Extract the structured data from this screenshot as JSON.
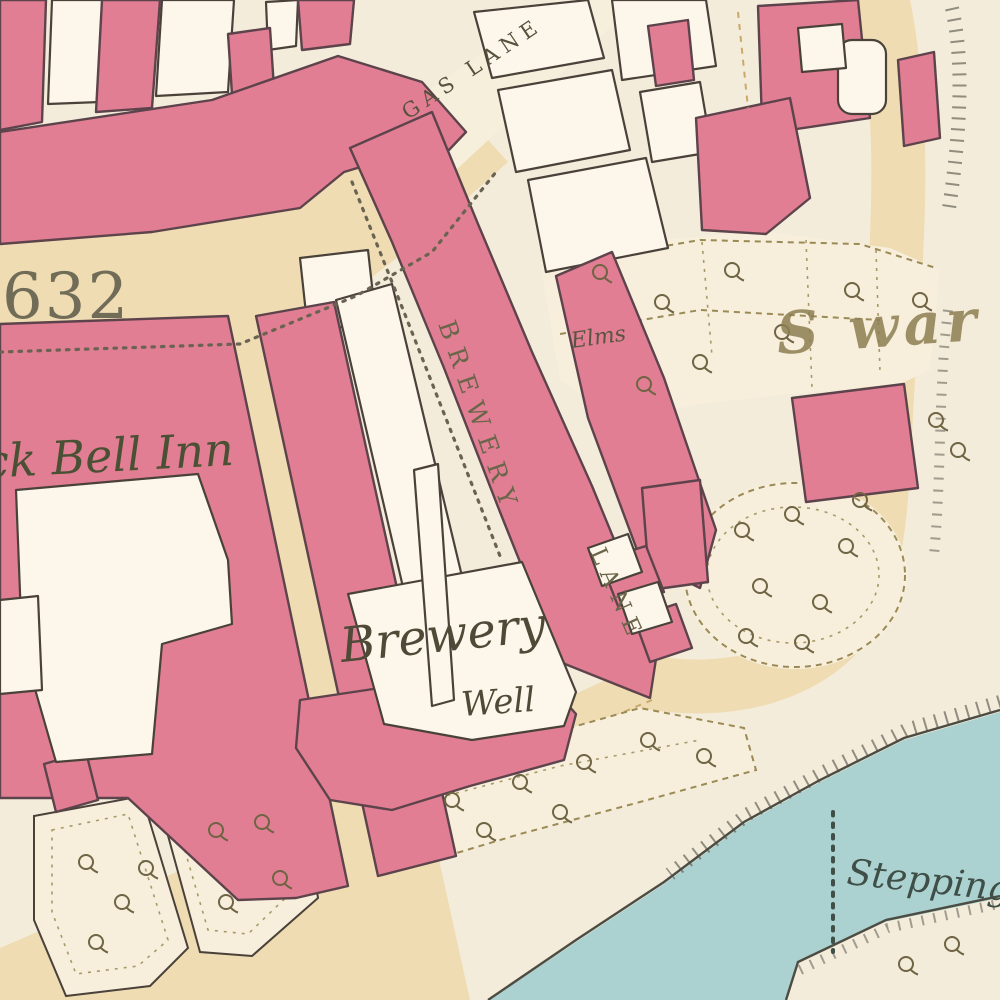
{
  "map": {
    "type": "historical-town-plan",
    "labels": {
      "plot_number": "632",
      "street_gas_lane": "GAS LANE",
      "street_brewery": "BREWERY",
      "street_brewery_lane_suffix": "LANE",
      "inn": "ck Bell Inn",
      "brewery_name": "Brewery",
      "brewery_well": "Well",
      "house_elms": "Elms",
      "district_gothic": "S war",
      "river_stepping": "Stepping"
    },
    "colors": {
      "background": "#f4ecda",
      "road": "#efdcb2",
      "road_light": "#f6efdb",
      "road_edge": "#c9a96b",
      "building": "#e17e93",
      "building_outline": "#5d434b",
      "outline_dark": "#4a423a",
      "courtyard": "#fcf7ea",
      "garden": "#f7efdc",
      "garden_line": "#9b8a55",
      "water": "#abd2d0",
      "bank": "#4c4c43",
      "tree": "#6f6443",
      "ink": "#56523d",
      "ink_green": "#4a5034",
      "boundary_dots": "#6b6352",
      "water_ink": "#3f4f48",
      "gothic_ink": "#8d7f52"
    }
  }
}
